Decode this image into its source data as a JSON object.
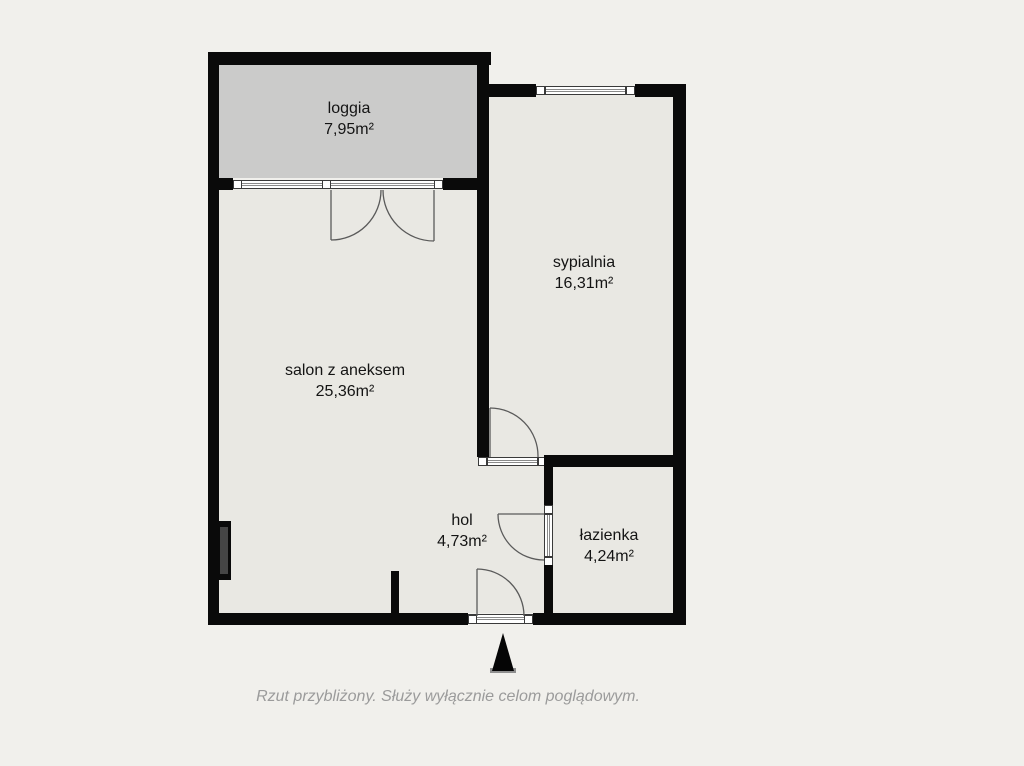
{
  "floorplan": {
    "rooms": {
      "loggia": {
        "name": "loggia",
        "area": "7,95m²"
      },
      "sypialnia": {
        "name": "sypialnia",
        "area": "16,31m²"
      },
      "salon": {
        "name": "salon z aneksem",
        "area": "25,36m²"
      },
      "hol": {
        "name": "hol",
        "area": "4,73m²"
      },
      "lazienka": {
        "name": "łazienka",
        "area": "4,24m²"
      }
    },
    "caption": "Rzut przybliżony. Służy wyłącznie celom poglądowym.",
    "colors": {
      "background": "#f1f0ec",
      "room_fill": "#e9e8e3",
      "loggia_fill": "#cbcbca",
      "wall": "#0a0a0a",
      "door_line": "#5a5a5a",
      "caption_text": "#9b9b9b"
    },
    "entrance_marker": "entrance-arrow"
  }
}
